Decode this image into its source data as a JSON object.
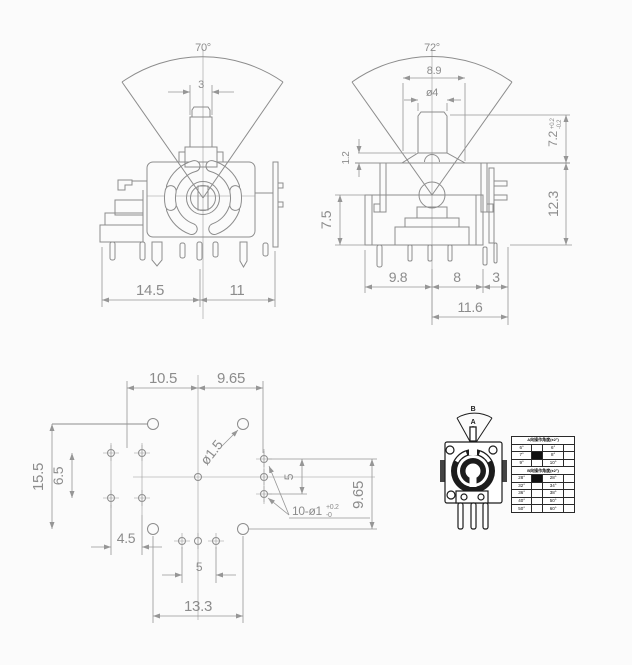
{
  "colors": {
    "line": "#8c8c8c",
    "dim_text": "#969696",
    "dark": "#1c1c1c",
    "background": "#fbfbfb"
  },
  "front_view": {
    "angle": "70°",
    "shaft_width": "3",
    "pitch_left": "14.5",
    "pitch_right": "11"
  },
  "side_view": {
    "angle": "72°",
    "flange_width": "8.9",
    "shaft_diameter": "ø4",
    "flange_thickness": "1.2",
    "body_height": "7.5",
    "shaft_height": "7.2",
    "shaft_height_tol_plus": "+0.2",
    "shaft_height_tol_minus": "-0.2",
    "overall_height": "12.3",
    "pitch_left": "9.8",
    "pitch_mid": "8",
    "pitch_right": "3",
    "pitch_overall": "11.6"
  },
  "footprint": {
    "pitch_top_left": "10.5",
    "pitch_top_right": "9.65",
    "height_outer": "15.5",
    "height_inner": "6.5",
    "mount_hole_diameter": "ø1.5",
    "pitch_bottom_small": "4.5",
    "pin_pitch": "5",
    "pitch_bottom_overall": "13.3",
    "height_right": "9.65",
    "pitch_right": "5",
    "pin_holes_count": "10-ø1",
    "pin_holes_tol_plus": "+0.2",
    "pin_holes_tol_minus": "-0"
  },
  "pictogram": {
    "direction_a": "A",
    "direction_b": "B"
  },
  "angle_table": {
    "header_a": "A向操作角度(±2°)",
    "rows_a": [
      {
        "c1": "6°",
        "c2": "6°"
      },
      {
        "c1": "7°",
        "c2": "8°"
      },
      {
        "c1": "9°",
        "c2": "10°"
      }
    ],
    "header_b": "B向操作角度(±2°)",
    "rows_b": [
      {
        "c1": "28°",
        "c2": "28°"
      },
      {
        "c1": "32°",
        "c2": "34°"
      },
      {
        "c1": "36°",
        "c2": "38°"
      },
      {
        "c1": "40°",
        "c2": "50°"
      },
      {
        "c1": "50°",
        "c2": "60°"
      }
    ]
  }
}
